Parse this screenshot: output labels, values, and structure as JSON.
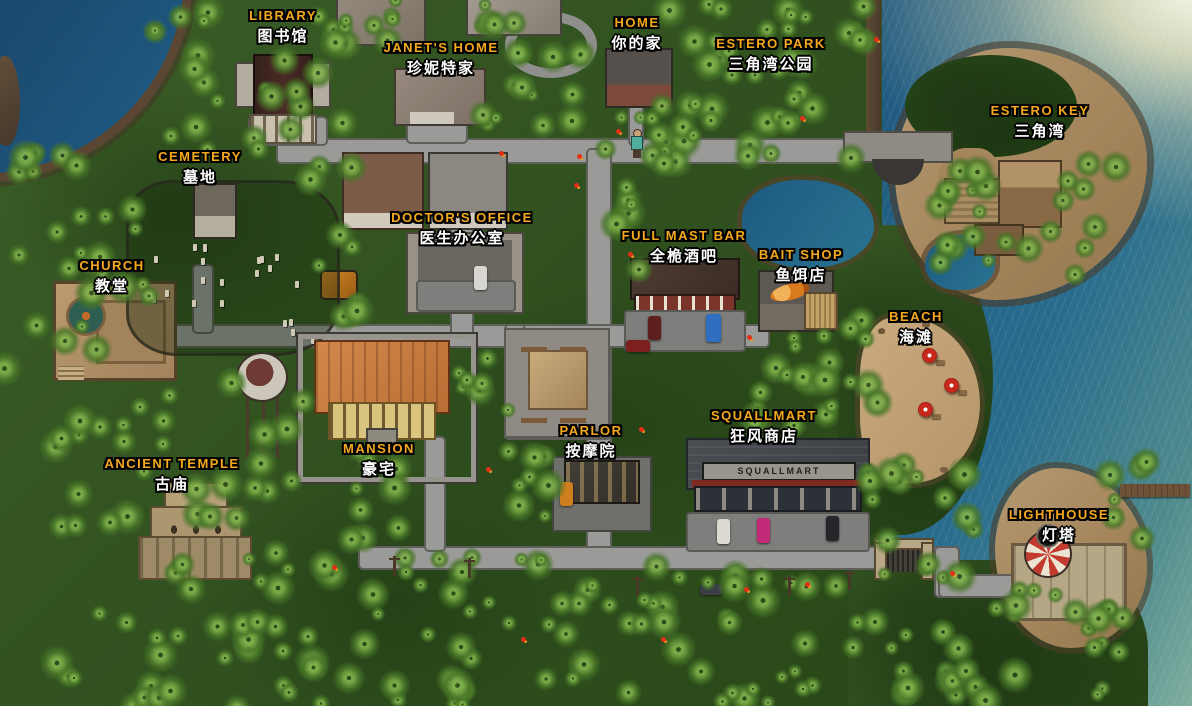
{
  "game_map": {
    "building_sign": "SQUALLMART"
  },
  "locations": [
    {
      "id": "library",
      "en": "LIBRARY",
      "zh": "图书馆"
    },
    {
      "id": "janets-home",
      "en": "JANET'S HOME",
      "zh": "珍妮特家"
    },
    {
      "id": "home",
      "en": "HOME",
      "zh": "你的家"
    },
    {
      "id": "estero-park",
      "en": "ESTERO PARK",
      "zh": "三角湾公园"
    },
    {
      "id": "estero-key",
      "en": "ESTERO KEY",
      "zh": "三角湾"
    },
    {
      "id": "cemetery",
      "en": "CEMETERY",
      "zh": "墓地"
    },
    {
      "id": "doctors-office",
      "en": "DOCTOR'S OFFICE",
      "zh": "医生办公室"
    },
    {
      "id": "church",
      "en": "CHURCH",
      "zh": "教堂"
    },
    {
      "id": "full-mast-bar",
      "en": "FULL MAST BAR",
      "zh": "全桅酒吧"
    },
    {
      "id": "bait-shop",
      "en": "BAIT SHOP",
      "zh": "鱼饵店"
    },
    {
      "id": "beach",
      "en": "BEACH",
      "zh": "海滩"
    },
    {
      "id": "squallmart",
      "en": "SQUALLMART",
      "zh": "狂风商店"
    },
    {
      "id": "parlor",
      "en": "PARLOR",
      "zh": "按摩院"
    },
    {
      "id": "mansion",
      "en": "MANSION",
      "zh": "豪宅"
    },
    {
      "id": "ancient-temple",
      "en": "ANCIENT TEMPLE",
      "zh": "古庙"
    },
    {
      "id": "lighthouse",
      "en": "LIGHTHOUSE",
      "zh": "灯塔"
    }
  ],
  "markers": {
    "player": "player-character",
    "parrot": "red-parrot-marker",
    "umbrella": "beach-umbrella"
  },
  "colors": {
    "label_gold": "#f5a81d",
    "label_white": "#ffffff",
    "ocean": "#1d567e",
    "jungle": "#2f4f1e",
    "road": "#9a9a98",
    "sand": "#c7a87c",
    "sign_red": "#7e1f18"
  }
}
